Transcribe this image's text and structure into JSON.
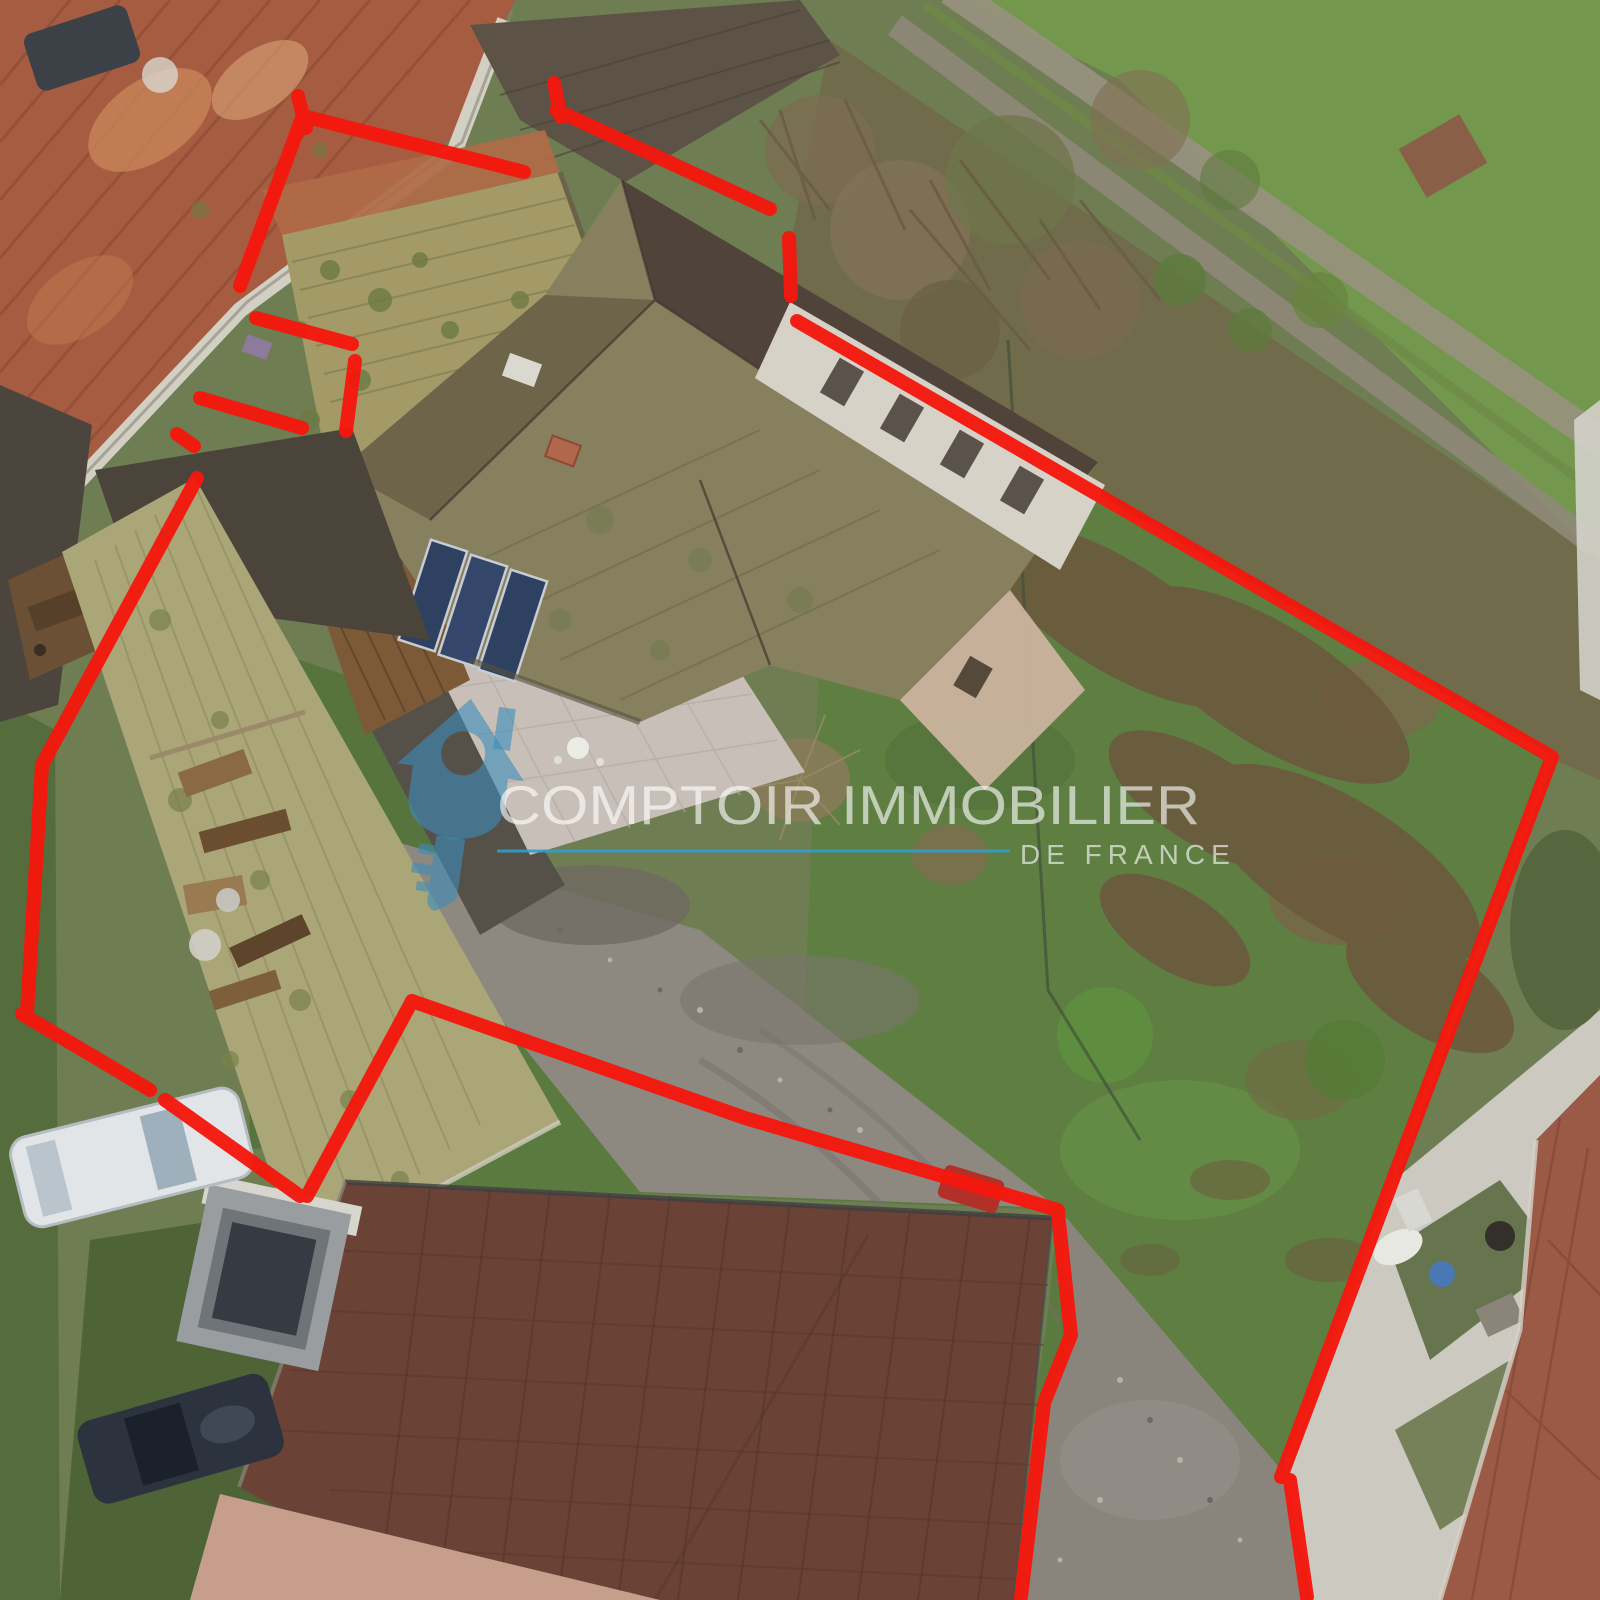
{
  "watermark": {
    "brand": "COMPTOIR IMMOBILIER",
    "region": "DE FRANCE",
    "text_color": "rgba(255,255,255,0.62)",
    "underline_color": "#2f9fcc",
    "logo_color": "rgba(58,140,185,0.60)"
  },
  "overlay": {
    "boundary_color": "#f5170d"
  }
}
